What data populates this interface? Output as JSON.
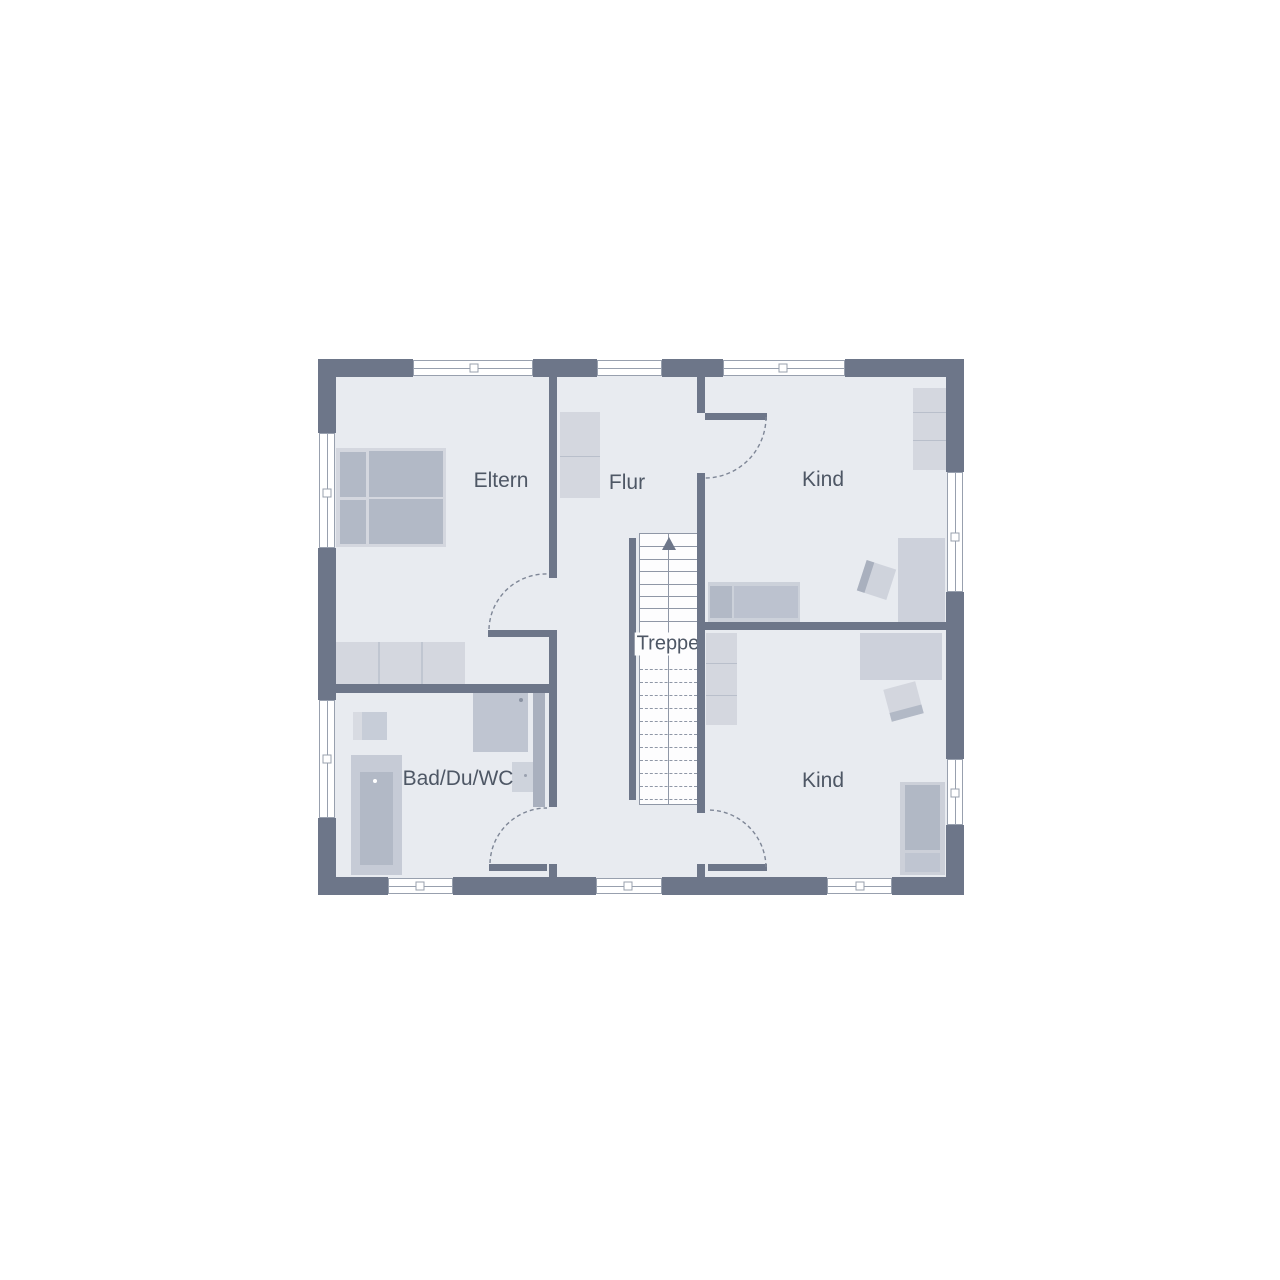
{
  "rooms": {
    "eltern": {
      "label": "Eltern"
    },
    "flur": {
      "label": "Flur"
    },
    "kind_top": {
      "label": "Kind"
    },
    "kind_bottom": {
      "label": "Kind"
    },
    "bad": {
      "label": "Bad/Du/WC"
    }
  },
  "stairs": {
    "label": "Treppe",
    "solid_treads": 9,
    "dashed_treads": 11,
    "direction_icon": "up-arrow"
  },
  "colors": {
    "wall": "#6d7689",
    "floor": "#e8ebf0",
    "furn_light": "#d4d7df",
    "furn_mid": "#c3c9d4",
    "furn_dark": "#b2b9c6",
    "furn_deep": "#a9b0be",
    "stair_bg": "#fdfdfe",
    "line": "#8f97a6",
    "win_border": "#98a0ae",
    "arc": "#7e8696",
    "label_text": "#4e5765",
    "background": "#ffffff"
  }
}
